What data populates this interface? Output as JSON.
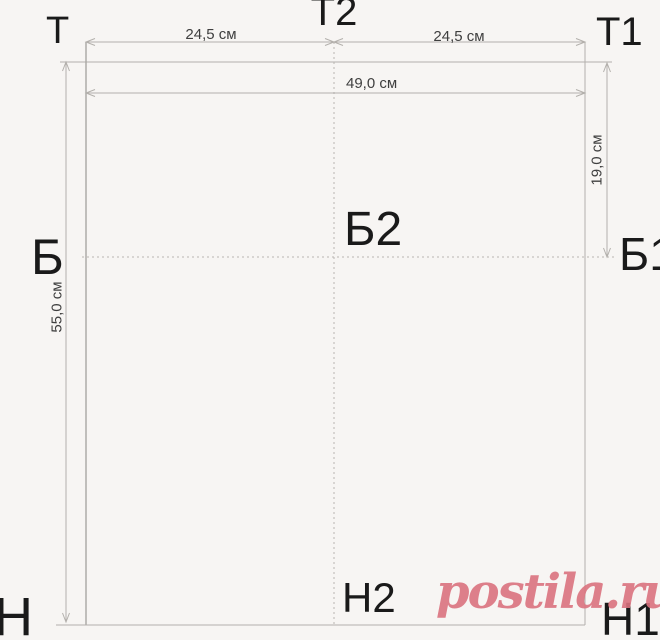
{
  "points": {
    "t": "Т",
    "t2": "Т2",
    "t1": "Т1",
    "b": "Б",
    "b2": "Б2",
    "b1": "Б1",
    "n": "Н",
    "n2": "Н2",
    "n1": "Н1"
  },
  "dimensions": {
    "top_left_half_width": "24,5 см",
    "top_right_half_width": "24,5 см",
    "total_width": "49,0 см",
    "total_height": "55,0 см",
    "top_to_hip_depth": "19,0 см"
  },
  "watermark": {
    "text": "postila.ru",
    "color": "#db737f"
  },
  "colors": {
    "background": "#f7f5f3",
    "line": "#b3b0ac",
    "dashed_line": "#b8b5b1",
    "label_text": "#1a1a1a",
    "dimension_text": "#3f3f3f"
  }
}
